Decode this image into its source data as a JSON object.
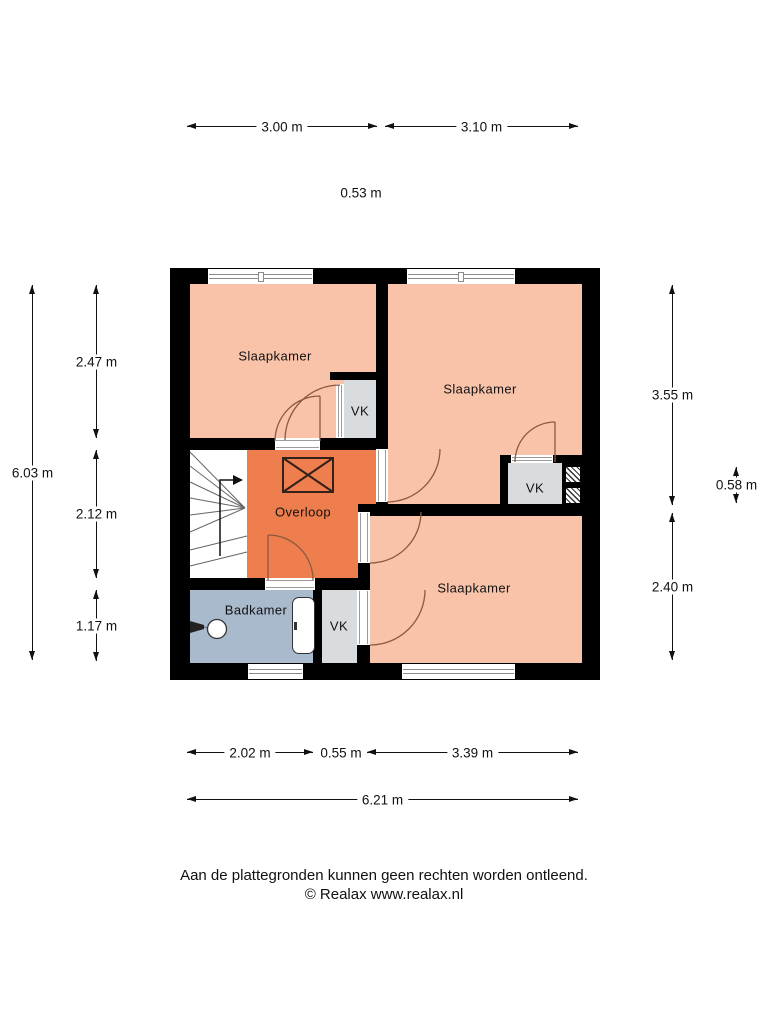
{
  "palette": {
    "wall": "#000000",
    "bedroom": "#f9c3aa",
    "landing": "#ee7e4d",
    "bathroom": "#a9bacd",
    "closet": "#d8dcde",
    "door_arc": "#8a5a40",
    "dim": "#111111",
    "background": "#ffffff"
  },
  "rooms": {
    "bedroom_top_left": "Slaapkamer",
    "bedroom_top_right": "Slaapkamer",
    "bedroom_bottom": "Slaapkamer",
    "landing": "Overloop",
    "bathroom": "Badkamer",
    "closet_top": "VK",
    "closet_right": "VK",
    "closet_bottom": "VK"
  },
  "dims": {
    "top1": "3.00 m",
    "top2": "3.10 m",
    "top_offset": "0.53 m",
    "left_total": "6.03 m",
    "left1": "2.47 m",
    "left2": "2.12 m",
    "left3": "1.17 m",
    "right1": "3.55 m",
    "right_offset": "0.58 m",
    "right2": "2.40 m",
    "bottom1": "2.02 m",
    "bottom_offset": "0.55 m",
    "bottom2": "3.39 m",
    "bottom_total": "6.21 m"
  },
  "footer": {
    "disclaimer": "Aan de plattegronden kunnen geen rechten worden ontleend.",
    "copyright": "© Realax www.realax.nl"
  }
}
